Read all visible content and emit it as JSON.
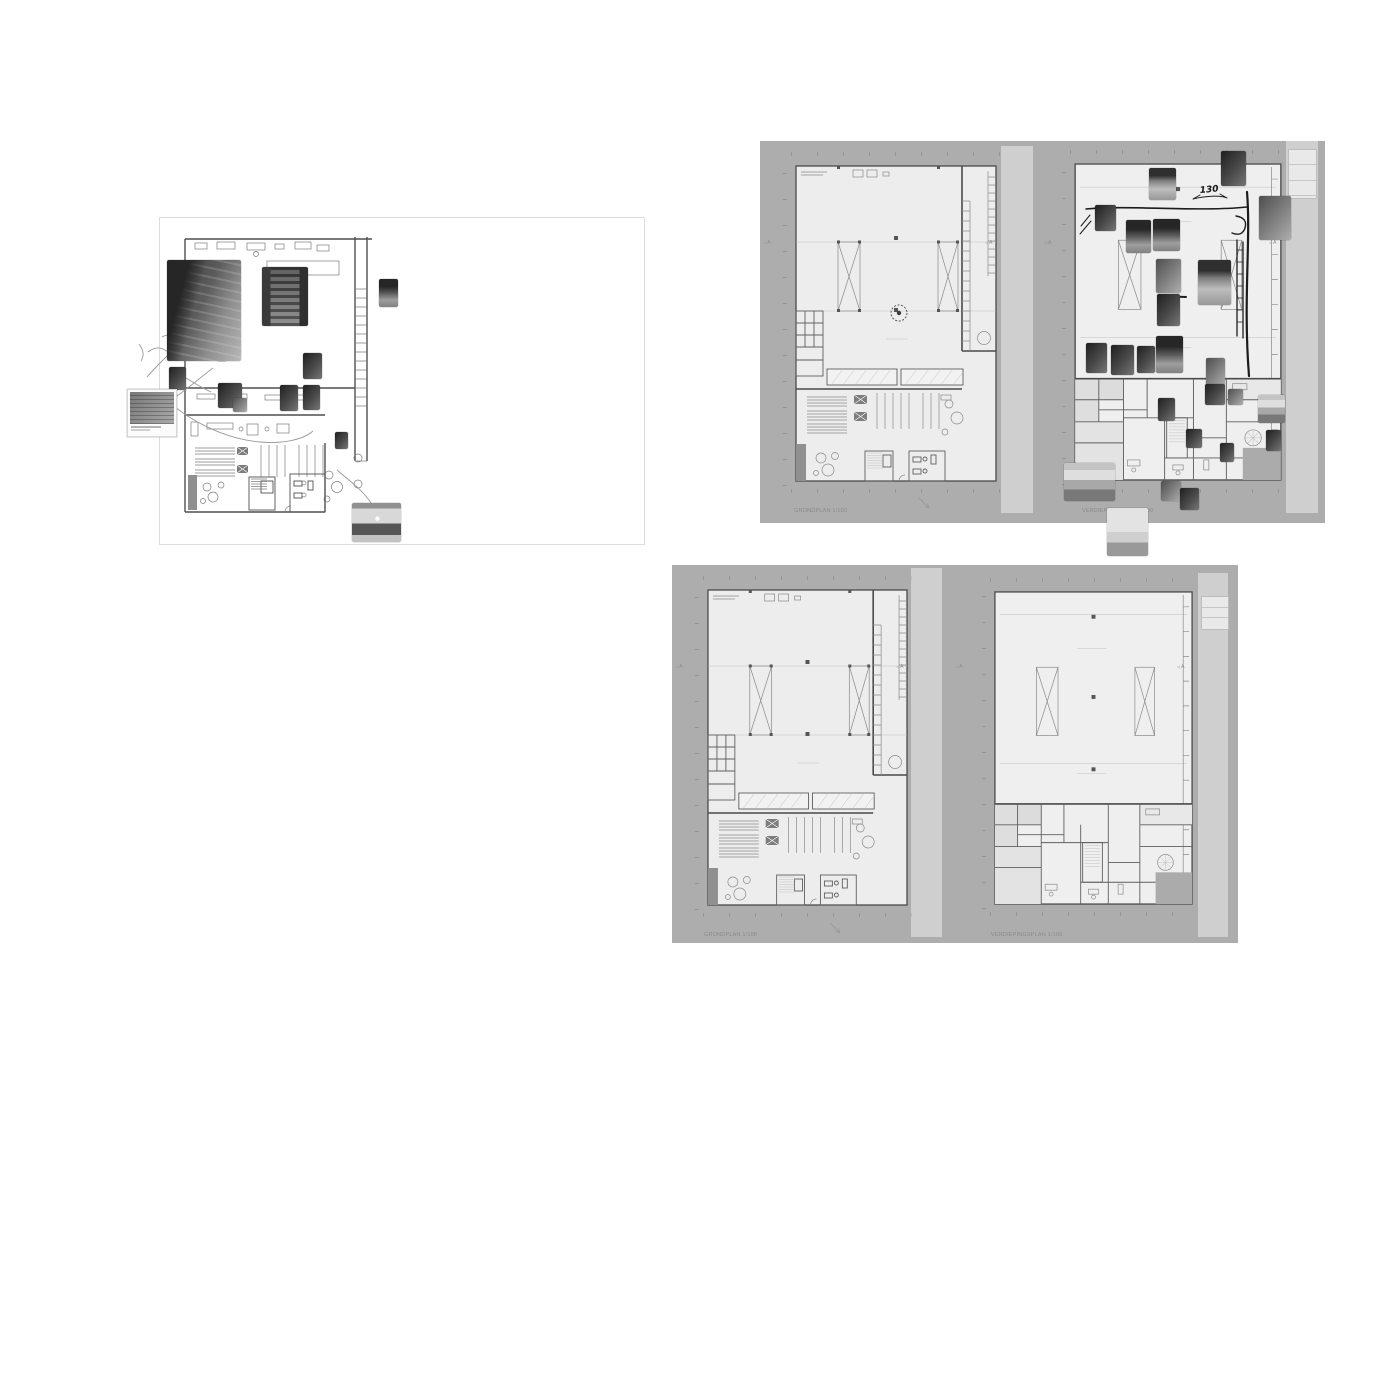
{
  "palette": {
    "page_bg": "#ffffff",
    "board_gray": "#adadad",
    "plan_fill": "#ededed",
    "wall_line": "#4a4a4a",
    "label_gray": "#8a8a8a",
    "overlay_strip": "rgba(255,255,255,0.42)",
    "ink_annotation": "#1c1c1c"
  },
  "plans": {
    "section_marker": "A",
    "grondplan_label": "GRONDPLAN 1/100",
    "verdiepingsplan_label": "VERDIEPINGSPLAN 1/100"
  },
  "annotations": {
    "dim_note": "130"
  },
  "boards": {
    "moodboard": {
      "photos": [
        {
          "name": "photo-warehouse-racks",
          "x": 167,
          "y": 260,
          "w": 74,
          "h": 101,
          "tone": "warehouse"
        },
        {
          "name": "photo-mezzanine-stairs",
          "x": 262,
          "y": 267,
          "w": 46,
          "h": 59,
          "tone": "stairs"
        },
        {
          "name": "photo-interior-small",
          "x": 379,
          "y": 279,
          "w": 19,
          "h": 28,
          "tone": "aisle"
        },
        {
          "name": "photo-machine",
          "x": 303,
          "y": 353,
          "w": 19,
          "h": 26,
          "tone": "dark"
        },
        {
          "name": "photo-side-rack",
          "x": 169,
          "y": 367,
          "w": 17,
          "h": 23,
          "tone": "dark"
        },
        {
          "name": "photo-framed-reference",
          "x": 127,
          "y": 389,
          "w": 50,
          "h": 48,
          "tone": "sketch",
          "frame": true
        },
        {
          "name": "photo-workbench-a",
          "x": 218,
          "y": 383,
          "w": 24,
          "h": 25,
          "tone": "dark"
        },
        {
          "name": "photo-workbench-b",
          "x": 233,
          "y": 398,
          "w": 14,
          "h": 14,
          "tone": "mid"
        },
        {
          "name": "photo-storage-a",
          "x": 280,
          "y": 385,
          "w": 18,
          "h": 26,
          "tone": "dark"
        },
        {
          "name": "photo-storage-b",
          "x": 303,
          "y": 385,
          "w": 17,
          "h": 25,
          "tone": "dark"
        },
        {
          "name": "photo-corner-detail",
          "x": 335,
          "y": 432,
          "w": 13,
          "h": 17,
          "tone": "dark"
        },
        {
          "name": "photo-reception-desk",
          "x": 352,
          "y": 503,
          "w": 49,
          "h": 39,
          "tone": "reception"
        }
      ]
    },
    "marked": {
      "photos": [
        {
          "name": "photo-ceiling-hall",
          "x": 1149,
          "y": 168,
          "w": 27,
          "h": 32,
          "tone": "ceiling"
        },
        {
          "name": "photo-dark-corner",
          "x": 1221,
          "y": 151,
          "w": 25,
          "h": 35,
          "tone": "dark"
        },
        {
          "name": "photo-machine-room",
          "x": 1259,
          "y": 196,
          "w": 32,
          "h": 44,
          "tone": "mid"
        },
        {
          "name": "photo-rack-left",
          "x": 1095,
          "y": 205,
          "w": 21,
          "h": 26,
          "tone": "dark"
        },
        {
          "name": "photo-aisle-a",
          "x": 1126,
          "y": 220,
          "w": 25,
          "h": 33,
          "tone": "aisle"
        },
        {
          "name": "photo-aisle-b",
          "x": 1153,
          "y": 219,
          "w": 27,
          "h": 32,
          "tone": "aisle"
        },
        {
          "name": "photo-shelving-mid",
          "x": 1156,
          "y": 259,
          "w": 25,
          "h": 34,
          "tone": "mid"
        },
        {
          "name": "photo-hall-wide",
          "x": 1198,
          "y": 260,
          "w": 33,
          "h": 45,
          "tone": "ceiling"
        },
        {
          "name": "photo-rack-close",
          "x": 1157,
          "y": 294,
          "w": 23,
          "h": 32,
          "tone": "dark"
        },
        {
          "name": "photo-store-shelves",
          "x": 1156,
          "y": 336,
          "w": 27,
          "h": 37,
          "tone": "aisle"
        },
        {
          "name": "photo-rack-row-a",
          "x": 1086,
          "y": 343,
          "w": 21,
          "h": 30,
          "tone": "dark"
        },
        {
          "name": "photo-rack-row-b",
          "x": 1111,
          "y": 345,
          "w": 23,
          "h": 30,
          "tone": "dark"
        },
        {
          "name": "photo-rack-row-c",
          "x": 1137,
          "y": 346,
          "w": 18,
          "h": 27,
          "tone": "dark"
        },
        {
          "name": "photo-detail-a",
          "x": 1206,
          "y": 358,
          "w": 19,
          "h": 28,
          "tone": "mid"
        },
        {
          "name": "photo-detail-b",
          "x": 1205,
          "y": 384,
          "w": 20,
          "h": 21,
          "tone": "dark"
        },
        {
          "name": "photo-detail-c",
          "x": 1228,
          "y": 389,
          "w": 15,
          "h": 16,
          "tone": "mid"
        },
        {
          "name": "photo-detail-d",
          "x": 1158,
          "y": 398,
          "w": 17,
          "h": 23,
          "tone": "dark"
        },
        {
          "name": "photo-detail-e",
          "x": 1186,
          "y": 429,
          "w": 16,
          "h": 19,
          "tone": "dark"
        },
        {
          "name": "photo-office-corner",
          "x": 1258,
          "y": 395,
          "w": 27,
          "h": 28,
          "tone": "office"
        },
        {
          "name": "photo-detail-f",
          "x": 1266,
          "y": 430,
          "w": 15,
          "h": 21,
          "tone": "dark"
        },
        {
          "name": "photo-detail-g",
          "x": 1220,
          "y": 443,
          "w": 14,
          "h": 19,
          "tone": "dark"
        },
        {
          "name": "photo-office-interior",
          "x": 1064,
          "y": 463,
          "w": 51,
          "h": 38,
          "tone": "office"
        },
        {
          "name": "photo-small-bottom-a",
          "x": 1161,
          "y": 481,
          "w": 20,
          "h": 20,
          "tone": "mid"
        },
        {
          "name": "photo-small-bottom-b",
          "x": 1180,
          "y": 488,
          "w": 19,
          "h": 22,
          "tone": "dark"
        },
        {
          "name": "photo-empty-room",
          "x": 1107,
          "y": 508,
          "w": 41,
          "h": 48,
          "tone": "room"
        }
      ]
    }
  }
}
